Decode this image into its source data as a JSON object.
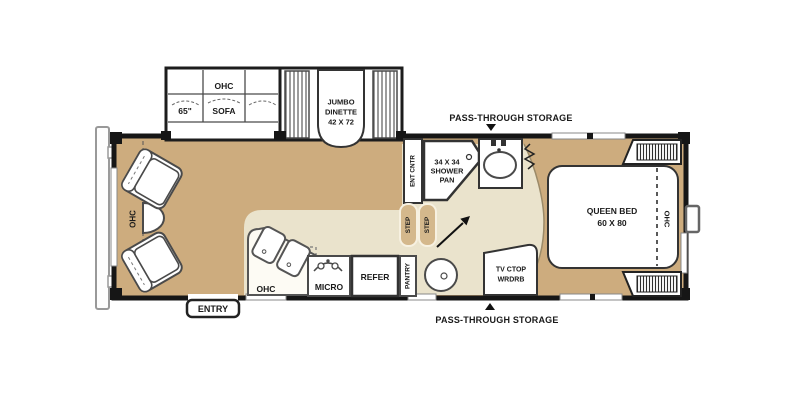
{
  "plan": {
    "front_ohc": "OHC",
    "sofa": {
      "ohc": "OHC",
      "size": "65\"",
      "name": "SOFA"
    },
    "dinette": {
      "l1": "JUMBO",
      "l2": "DINETTE",
      "l3": "42 X 72"
    },
    "storage_top": "PASS-THROUGH STORAGE",
    "storage_bottom": "PASS-THROUGH STORAGE",
    "ent_cntr": "ENT CNTR",
    "shower": {
      "l1": "34 X 34",
      "l2": "SHOWER",
      "l3": "PAN"
    },
    "step1": "STEP",
    "step2": "STEP",
    "kitchen": {
      "ohc": "OHC",
      "micro": "MICRO",
      "refer": "REFER",
      "pantry": "PANTRY"
    },
    "entry": "ENTRY",
    "tv": {
      "l1": "TV CTOP",
      "l2": "WRDRB"
    },
    "bed": {
      "l1": "QUEEN BED",
      "l2": "60 X 80"
    },
    "bedroom_ohc": "OHC"
  },
  "colors": {
    "floor_tan": "#cdac7e",
    "floor_light": "#eae3cc",
    "wall": "#161616",
    "fixture_outline": "#4a4a4a",
    "step_fill": "#d4b88c",
    "background": "#ffffff"
  }
}
